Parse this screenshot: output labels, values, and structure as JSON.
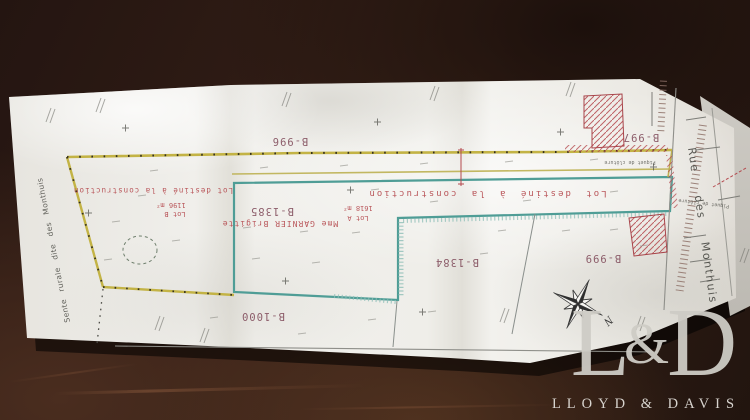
{
  "plan": {
    "parcel_numbers": {
      "b996": "B-996",
      "b997": "B-997",
      "b999": "B-999",
      "b1000": "B-1000",
      "b1384": "B-1384",
      "b1385": "B-1385"
    },
    "labels": {
      "lot_construction_left": "Lot destiné à la construction",
      "lot_construction_right": "Lot destiné à la construction",
      "owner": "Mme GARNIER Brigitte",
      "lot_a_name": "Lot A",
      "lot_a_area": "1618 m²",
      "lot_b_name": "Lot B",
      "lot_b_area": "1196 m²",
      "fence": "Piquet de clôture",
      "street_right": "Rue des Monthuis",
      "path_left": "Sente rurale dite des Monthuis",
      "north": "N"
    },
    "colors": {
      "boundary_yellow": "#c3b345",
      "boundary_teal": "#4f9d96",
      "annotation_red": "#b5494e",
      "parcel_number": "#7d4656"
    }
  },
  "watermark": {
    "monogram_l": "L",
    "monogram_amp": "&",
    "monogram_d": "D",
    "name": "LLOYD & DAVIS"
  }
}
